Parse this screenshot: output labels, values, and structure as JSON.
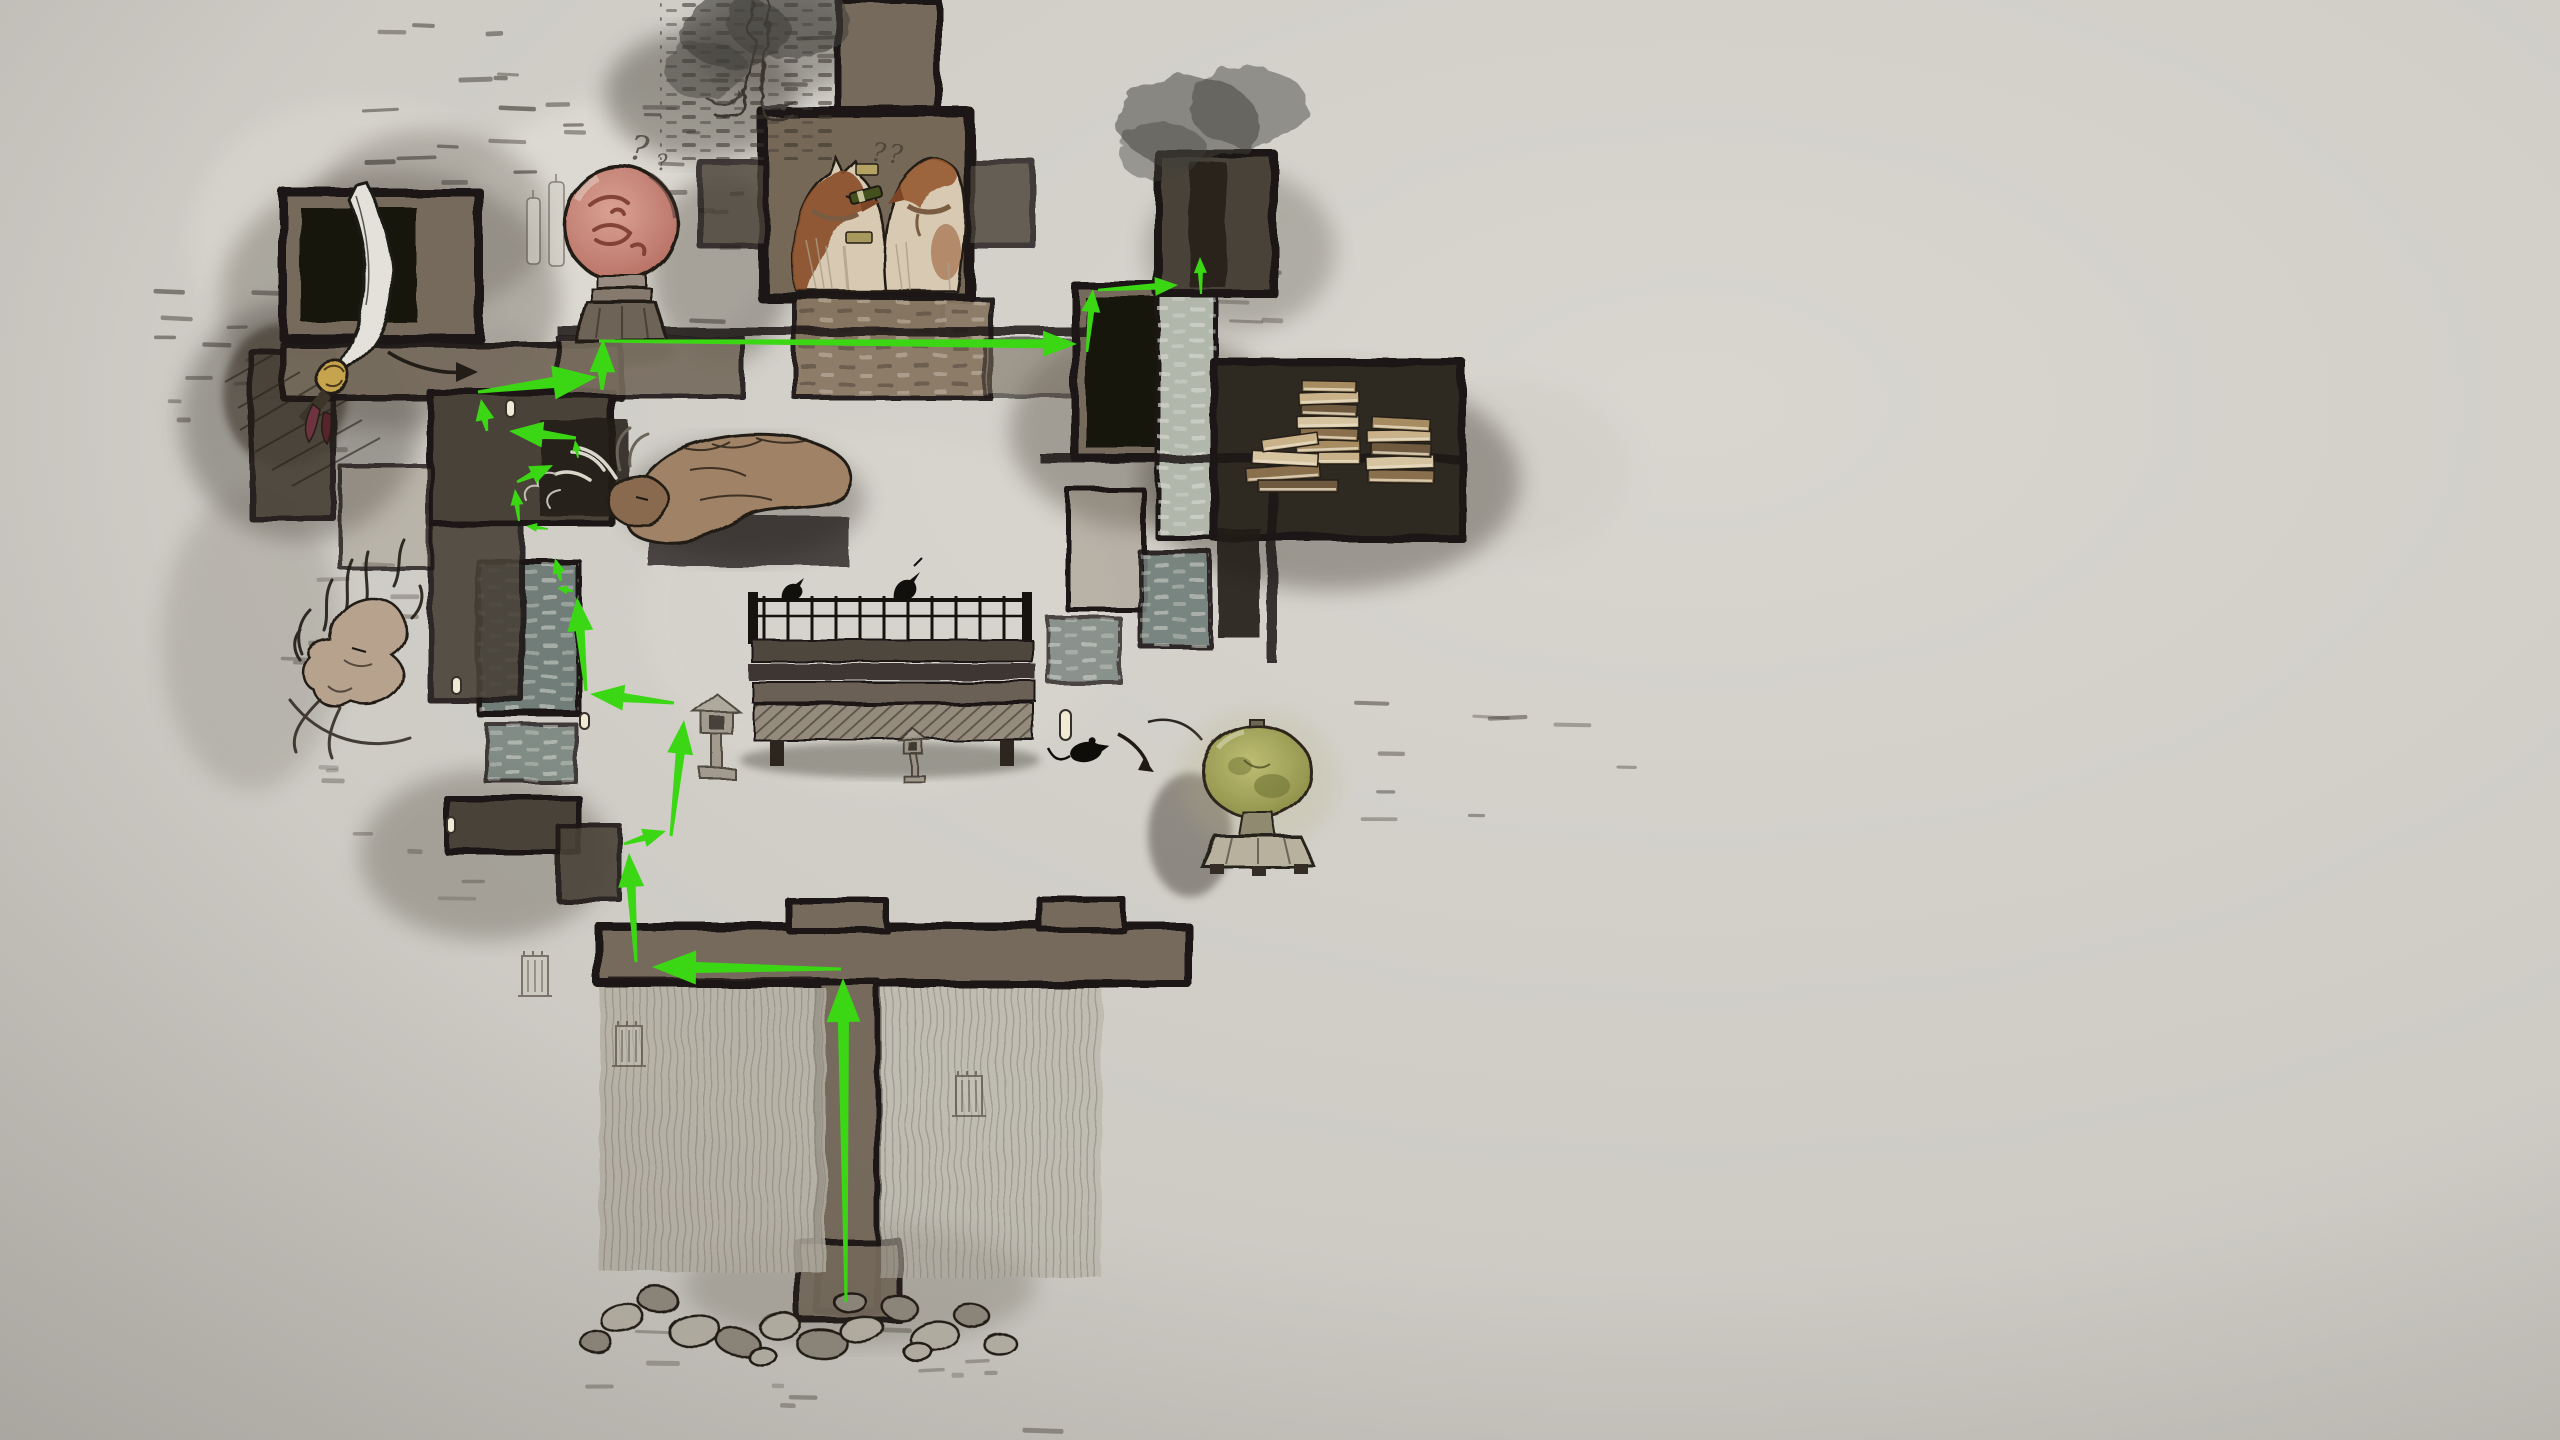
{
  "scene": {
    "width": 2560,
    "height": 1440,
    "description": "hand-drawn ink-wash dungeon map with green route overlay"
  },
  "palette": {
    "bg_light": "#d8d6cf",
    "bg_mid": "#c9c7c0",
    "bg_dark": "#b5b3ac",
    "ink": "#1c1813",
    "room_warm": "#746a5c",
    "room_dark": "#4a4238",
    "room_deep": "#2e2922",
    "room_black": "#17130e",
    "brick_light": "#b2b7ac",
    "brick_blue": "#6f7d78",
    "brick_warm": "#8a7864",
    "wall_brown": "#766856",
    "route_green": "#3cd714",
    "face_pink": "#c9837a",
    "face_line": "#7d3a2f",
    "dog_brown": "#8a4f2b",
    "dog_cream": "#d8cab2",
    "lantern_green": "#9a9b4a",
    "book_tan": "#c9b28a",
    "paper": "#e9e7e0"
  },
  "annotations": {
    "face_mark_primary": "?",
    "face_mark_secondary": "?",
    "kennel_marks": "??"
  },
  "route": {
    "color": "#3cd714",
    "presets": {
      "xl": {
        "hl": 44,
        "hw": 34,
        "nw": 11,
        "tw": 3
      },
      "l": {
        "hl": 34,
        "hw": 26,
        "nw": 9,
        "tw": 3
      },
      "m": {
        "hl": 23,
        "hw": 19,
        "nw": 6.5,
        "tw": 2.5
      },
      "s": {
        "hl": 16,
        "hw": 13,
        "nw": 5,
        "tw": 2
      },
      "xs": {
        "hl": 11,
        "hw": 9,
        "nw": 3.5,
        "tw": 1.5
      }
    },
    "arrows": [
      {
        "x1": 846,
        "y1": 1302,
        "x2": 843,
        "y2": 978,
        "s": "xl"
      },
      {
        "x1": 841,
        "y1": 969,
        "x2": 652,
        "y2": 967,
        "s": "xl"
      },
      {
        "x1": 636,
        "y1": 962,
        "x2": 629,
        "y2": 853,
        "s": "l"
      },
      {
        "x1": 624,
        "y1": 844,
        "x2": 666,
        "y2": 831,
        "s": "m"
      },
      {
        "x1": 671,
        "y1": 836,
        "x2": 684,
        "y2": 720,
        "s": "l"
      },
      {
        "x1": 674,
        "y1": 703,
        "x2": 590,
        "y2": 694,
        "s": "l"
      },
      {
        "x1": 586,
        "y1": 691,
        "x2": 577,
        "y2": 597,
        "s": "l"
      },
      {
        "x1": 573,
        "y1": 591,
        "x2": 557,
        "y2": 588,
        "s": "xs"
      },
      {
        "x1": 561,
        "y1": 581,
        "x2": 555,
        "y2": 558,
        "s": "s"
      },
      {
        "x1": 548,
        "y1": 529,
        "x2": 526,
        "y2": 526,
        "s": "xs"
      },
      {
        "x1": 519,
        "y1": 521,
        "x2": 515,
        "y2": 489,
        "s": "s"
      },
      {
        "x1": 517,
        "y1": 482,
        "x2": 553,
        "y2": 465,
        "s": "m"
      },
      {
        "x1": 578,
        "y1": 458,
        "x2": 575,
        "y2": 440,
        "s": "xs"
      },
      {
        "x1": 576,
        "y1": 438,
        "x2": 509,
        "y2": 431,
        "s": "l"
      },
      {
        "x1": 487,
        "y1": 431,
        "x2": 481,
        "y2": 399,
        "s": "m"
      },
      {
        "x1": 478,
        "y1": 392,
        "x2": 597,
        "y2": 377,
        "s": "xl"
      },
      {
        "x1": 602,
        "y1": 390,
        "x2": 603,
        "y2": 339,
        "s": "l"
      },
      {
        "x1": 599,
        "y1": 341,
        "x2": 1077,
        "y2": 344,
        "s": "l"
      },
      {
        "x1": 1087,
        "y1": 352,
        "x2": 1093,
        "y2": 289,
        "s": "m"
      },
      {
        "x1": 1098,
        "y1": 290,
        "x2": 1178,
        "y2": 285,
        "s": "m"
      },
      {
        "x1": 1201,
        "y1": 294,
        "x2": 1200,
        "y2": 257,
        "s": "s"
      }
    ]
  },
  "map": {
    "washes": [
      {
        "cx": 620,
        "cy": 230,
        "rx": 160,
        "ry": 130,
        "f": "#e6e3db",
        "op": 0.55,
        "b": 2
      },
      {
        "cx": 360,
        "cy": 240,
        "rx": 170,
        "ry": 140,
        "f": "#dcd9d1",
        "op": 0.5,
        "b": 2
      },
      {
        "cx": 880,
        "cy": 610,
        "rx": 240,
        "ry": 180,
        "f": "#d8d6ce",
        "op": 0.6,
        "b": 2
      },
      {
        "cx": 1500,
        "cy": 470,
        "rx": 130,
        "ry": 90,
        "f": "#cfccc5",
        "op": 0.5,
        "b": 2
      },
      {
        "cx": 390,
        "cy": 300,
        "rx": 170,
        "ry": 130,
        "f": "#4b443b",
        "op": 0.3,
        "b": 2
      },
      {
        "cx": 300,
        "cy": 420,
        "rx": 120,
        "ry": 120,
        "f": "#3e3830",
        "op": 0.35,
        "b": 2
      },
      {
        "cx": 430,
        "cy": 220,
        "rx": 120,
        "ry": 90,
        "f": "#514a40",
        "op": 0.28,
        "b": 2
      },
      {
        "cx": 720,
        "cy": 270,
        "rx": 70,
        "ry": 95,
        "f": "#443d34",
        "op": 0.35,
        "b": 2
      },
      {
        "cx": 1330,
        "cy": 480,
        "rx": 190,
        "ry": 110,
        "f": "#453e35",
        "op": 0.4,
        "b": 2
      },
      {
        "cx": 1150,
        "cy": 430,
        "rx": 140,
        "ry": 100,
        "f": "#3c352c",
        "op": 0.33,
        "b": 2
      },
      {
        "cx": 700,
        "cy": 95,
        "rx": 95,
        "ry": 65,
        "f": "#4f4b43",
        "op": 0.45,
        "b": 2
      },
      {
        "cx": 778,
        "cy": 42,
        "rx": 85,
        "ry": 52,
        "f": "#545048",
        "op": 0.4,
        "b": 2
      },
      {
        "cx": 860,
        "cy": 1285,
        "rx": 175,
        "ry": 60,
        "f": "#6b6358",
        "op": 0.3,
        "b": 2
      },
      {
        "cx": 485,
        "cy": 855,
        "rx": 125,
        "ry": 85,
        "f": "#463f36",
        "op": 0.3,
        "b": 2
      },
      {
        "cx": 252,
        "cy": 640,
        "rx": 90,
        "ry": 150,
        "f": "#6e675d",
        "op": 0.22,
        "b": 2
      },
      {
        "cx": 1240,
        "cy": 250,
        "rx": 95,
        "ry": 80,
        "f": "#59524a",
        "op": 0.3,
        "b": 2
      },
      {
        "cx": 285,
        "cy": 395,
        "rx": 62,
        "ry": 72,
        "f": "#2b2119",
        "op": 0.5,
        "b": 1
      },
      {
        "cx": 890,
        "cy": 760,
        "rx": 150,
        "ry": 18,
        "f": "#2b261f",
        "op": 0.35,
        "b": 1
      },
      {
        "cx": 1190,
        "cy": 835,
        "rx": 42,
        "ry": 62,
        "f": "#3c362d",
        "op": 0.45,
        "b": 1
      },
      {
        "cx": 622,
        "cy": 352,
        "rx": 55,
        "ry": 14,
        "f": "#35302a",
        "op": 0.45,
        "b": 1
      },
      {
        "cx": 745,
        "cy": 500,
        "rx": 120,
        "ry": 60,
        "f": "#3a332b",
        "op": 0.3,
        "b": 2
      }
    ],
    "foliage": [
      {
        "cx": 735,
        "cy": 32,
        "rx": 55,
        "ry": 36,
        "op": 0.6
      },
      {
        "cx": 788,
        "cy": 20,
        "rx": 62,
        "ry": 40,
        "op": 0.55
      },
      {
        "cx": 706,
        "cy": 70,
        "rx": 42,
        "ry": 28,
        "op": 0.45
      },
      {
        "cx": 1188,
        "cy": 122,
        "rx": 70,
        "ry": 45,
        "op": 0.5
      },
      {
        "cx": 1248,
        "cy": 106,
        "rx": 60,
        "ry": 40,
        "op": 0.45
      },
      {
        "cx": 1162,
        "cy": 152,
        "rx": 45,
        "ry": 30,
        "op": 0.4
      }
    ],
    "rooms": [
      {
        "n": "room-topleft",
        "x": 283,
        "y": 192,
        "w": 196,
        "h": 146,
        "t": "warm",
        "sw": 9
      },
      {
        "n": "room-topleft-inner",
        "x": 301,
        "y": 208,
        "w": 116,
        "h": 114,
        "t": "black",
        "sw": 0
      },
      {
        "n": "room-left-wing",
        "x": 251,
        "y": 352,
        "w": 82,
        "h": 166,
        "t": "dark",
        "sw": 6,
        "op": 0.9
      },
      {
        "n": "corridor-left",
        "x": 283,
        "y": 344,
        "w": 338,
        "h": 54,
        "t": "warm",
        "sw": 6,
        "op": 0.95
      },
      {
        "n": "room-mid-cluster",
        "x": 430,
        "y": 392,
        "w": 182,
        "h": 132,
        "t": "dark",
        "sw": 7
      },
      {
        "n": "room-mid-black",
        "x": 540,
        "y": 420,
        "w": 88,
        "h": 96,
        "t": "slab",
        "sw": 0,
        "op": 0.85
      },
      {
        "n": "room-bluebrick",
        "x": 479,
        "y": 562,
        "w": 100,
        "h": 152,
        "t": "brickB",
        "sw": 6
      },
      {
        "n": "room-left-mid",
        "x": 430,
        "y": 524,
        "w": 92,
        "h": 176,
        "t": "dark",
        "sw": 6,
        "op": 0.9
      },
      {
        "n": "brick-floor",
        "x": 486,
        "y": 724,
        "w": 90,
        "h": 58,
        "t": "brickB",
        "sw": 4,
        "op": 0.8
      },
      {
        "n": "room-low-1",
        "x": 447,
        "y": 798,
        "w": 132,
        "h": 54,
        "t": "dark",
        "sw": 6
      },
      {
        "n": "room-low-2",
        "x": 558,
        "y": 826,
        "w": 62,
        "h": 74,
        "t": "dark",
        "sw": 5,
        "op": 0.9
      },
      {
        "n": "room-railing",
        "x": 340,
        "y": 466,
        "w": 92,
        "h": 102,
        "t": "outline",
        "sw": 4,
        "op": 0.8
      },
      {
        "n": "chimney",
        "x": 838,
        "y": 0,
        "w": 100,
        "h": 118,
        "t": "warm",
        "sw": 7
      },
      {
        "n": "kennel-room",
        "x": 763,
        "y": 112,
        "w": 206,
        "h": 186,
        "t": "kennel",
        "sw": 11
      },
      {
        "n": "kennel-arm-left",
        "x": 700,
        "y": 162,
        "w": 66,
        "h": 84,
        "t": "dark",
        "sw": 6,
        "op": 0.8
      },
      {
        "n": "kennel-arm-right",
        "x": 967,
        "y": 162,
        "w": 66,
        "h": 84,
        "t": "dark",
        "sw": 6,
        "op": 0.8
      },
      {
        "n": "kennel-base",
        "x": 800,
        "y": 294,
        "w": 142,
        "h": 50,
        "t": "dark",
        "sw": 6
      },
      {
        "n": "brick-below-kennel",
        "x": 795,
        "y": 298,
        "w": 196,
        "h": 100,
        "t": "brickW",
        "sw": 5,
        "op": 0.95
      },
      {
        "n": "corridor-main",
        "x": 558,
        "y": 338,
        "w": 184,
        "h": 58,
        "t": "warm",
        "sw": 5,
        "op": 0.9
      },
      {
        "n": "corridor-main-fade",
        "x": 985,
        "y": 340,
        "w": 100,
        "h": 56,
        "t": "warm",
        "sw": 4,
        "op": 0.55
      },
      {
        "n": "tr-room",
        "x": 1075,
        "y": 286,
        "w": 96,
        "h": 172,
        "t": "warm",
        "sw": 8
      },
      {
        "n": "tr-room-inner",
        "x": 1086,
        "y": 298,
        "w": 70,
        "h": 150,
        "t": "black",
        "sw": 0
      },
      {
        "n": "tr-shaft",
        "x": 1158,
        "y": 286,
        "w": 58,
        "h": 252,
        "t": "brickL",
        "sw": 5
      },
      {
        "n": "tr-tower",
        "x": 1158,
        "y": 154,
        "w": 116,
        "h": 140,
        "t": "dark",
        "sw": 8
      },
      {
        "n": "tr-tower-inner",
        "x": 1190,
        "y": 162,
        "w": 36,
        "h": 126,
        "t": "slab",
        "sw": 0,
        "op": 0.8
      },
      {
        "n": "books-room",
        "x": 1214,
        "y": 362,
        "w": 248,
        "h": 176,
        "t": "deep",
        "sw": 8
      },
      {
        "n": "tr-mid-room-1",
        "x": 1068,
        "y": 490,
        "w": 76,
        "h": 120,
        "t": "outline",
        "sw": 5
      },
      {
        "n": "tr-mid-room-2",
        "x": 1140,
        "y": 552,
        "w": 70,
        "h": 94,
        "t": "brickB",
        "sw": 5,
        "op": 0.9
      },
      {
        "n": "tr-mid-room-3",
        "x": 1048,
        "y": 618,
        "w": 72,
        "h": 64,
        "t": "brickB",
        "sw": 4,
        "op": 0.75
      },
      {
        "n": "tr-slab",
        "x": 1218,
        "y": 528,
        "w": 42,
        "h": 110,
        "t": "slab",
        "sw": 0,
        "op": 0.9
      },
      {
        "n": "bottom-bar",
        "x": 598,
        "y": 926,
        "w": 590,
        "h": 58,
        "t": "warm",
        "sw": 8
      },
      {
        "n": "bar-notch-1",
        "x": 788,
        "y": 900,
        "w": 98,
        "h": 30,
        "t": "warm",
        "sw": 6
      },
      {
        "n": "bar-notch-2",
        "x": 1040,
        "y": 900,
        "w": 84,
        "h": 30,
        "t": "warm",
        "sw": 6
      },
      {
        "n": "bottom-shaft",
        "x": 818,
        "y": 982,
        "w": 60,
        "h": 330,
        "t": "warm",
        "sw": 7
      },
      {
        "n": "bottom-flare",
        "x": 798,
        "y": 1242,
        "w": 102,
        "h": 78,
        "t": "warm",
        "sw": 6,
        "op": 0.95
      },
      {
        "n": "hatch-left",
        "x": 600,
        "y": 988,
        "w": 226,
        "h": 284,
        "t": "hatch",
        "sw": 0,
        "op": 0.85
      },
      {
        "n": "hatch-right",
        "x": 880,
        "y": 988,
        "w": 222,
        "h": 290,
        "t": "hatch",
        "sw": 0,
        "op": 0.55
      }
    ],
    "walls": [
      {
        "x": 558,
        "y": 327,
        "w": 532,
        "h": 9
      },
      {
        "x": 1040,
        "y": 454,
        "w": 420,
        "h": 9
      },
      {
        "x": 1267,
        "y": 463,
        "w": 10,
        "h": 200
      },
      {
        "x": 610,
        "y": 978,
        "w": 220,
        "h": 7
      }
    ],
    "doors": [
      {
        "x": 506,
        "y": 400,
        "w": 9,
        "h": 17
      },
      {
        "x": 452,
        "y": 677,
        "w": 9,
        "h": 17
      },
      {
        "x": 580,
        "y": 713,
        "w": 9,
        "h": 16
      },
      {
        "x": 447,
        "y": 817,
        "w": 8,
        "h": 16
      },
      {
        "x": 1060,
        "y": 710,
        "w": 11,
        "h": 30
      }
    ],
    "towers": [
      {
        "x": 522,
        "y": 956
      },
      {
        "x": 616,
        "y": 1026
      },
      {
        "x": 956,
        "y": 1076
      }
    ],
    "rocks": [
      {
        "cx": 622,
        "cy": 1318,
        "rx": 22,
        "ry": 14,
        "r": -8,
        "d": 0
      },
      {
        "cx": 658,
        "cy": 1300,
        "rx": 20,
        "ry": 13,
        "r": 6,
        "d": 1
      },
      {
        "cx": 694,
        "cy": 1330,
        "rx": 26,
        "ry": 16,
        "r": -4,
        "d": 0
      },
      {
        "cx": 738,
        "cy": 1342,
        "rx": 22,
        "ry": 13,
        "r": 10,
        "d": 1
      },
      {
        "cx": 780,
        "cy": 1326,
        "rx": 20,
        "ry": 12,
        "r": -12,
        "d": 0
      },
      {
        "cx": 822,
        "cy": 1344,
        "rx": 26,
        "ry": 15,
        "r": 4,
        "d": 1
      },
      {
        "cx": 862,
        "cy": 1330,
        "rx": 22,
        "ry": 13,
        "r": -6,
        "d": 0
      },
      {
        "cx": 900,
        "cy": 1308,
        "rx": 18,
        "ry": 12,
        "r": 8,
        "d": 1
      },
      {
        "cx": 934,
        "cy": 1336,
        "rx": 24,
        "ry": 14,
        "r": -10,
        "d": 0
      },
      {
        "cx": 972,
        "cy": 1316,
        "rx": 18,
        "ry": 11,
        "r": 6,
        "d": 1
      },
      {
        "cx": 1000,
        "cy": 1344,
        "rx": 16,
        "ry": 10,
        "r": -4,
        "d": 0
      },
      {
        "cx": 596,
        "cy": 1342,
        "rx": 16,
        "ry": 11,
        "r": 6,
        "d": 1
      },
      {
        "cx": 850,
        "cy": 1302,
        "rx": 16,
        "ry": 10,
        "r": 0,
        "d": 1
      },
      {
        "cx": 918,
        "cy": 1352,
        "rx": 14,
        "ry": 9,
        "r": 0,
        "d": 0
      },
      {
        "cx": 762,
        "cy": 1356,
        "rx": 14,
        "ry": 9,
        "r": 0,
        "d": 0
      }
    ],
    "books": [
      {
        "x": 1298,
        "y": 452,
        "w": 62,
        "h": 12,
        "r": 0
      },
      {
        "x": 1296,
        "y": 440,
        "w": 64,
        "h": 12,
        "r": -2
      },
      {
        "x": 1300,
        "y": 428,
        "w": 58,
        "h": 12,
        "r": 2
      },
      {
        "x": 1297,
        "y": 416,
        "w": 62,
        "h": 12,
        "r": -1
      },
      {
        "x": 1301,
        "y": 404,
        "w": 56,
        "h": 12,
        "r": 2
      },
      {
        "x": 1299,
        "y": 392,
        "w": 60,
        "h": 12,
        "r": -2
      },
      {
        "x": 1302,
        "y": 381,
        "w": 54,
        "h": 11,
        "r": 1
      },
      {
        "x": 1368,
        "y": 470,
        "w": 66,
        "h": 13,
        "r": 1
      },
      {
        "x": 1366,
        "y": 456,
        "w": 68,
        "h": 13,
        "r": -2
      },
      {
        "x": 1371,
        "y": 443,
        "w": 60,
        "h": 13,
        "r": 2
      },
      {
        "x": 1367,
        "y": 430,
        "w": 64,
        "h": 12,
        "r": -1
      },
      {
        "x": 1372,
        "y": 418,
        "w": 58,
        "h": 12,
        "r": 3
      },
      {
        "x": 1246,
        "y": 466,
        "w": 74,
        "h": 14,
        "r": -4
      },
      {
        "x": 1252,
        "y": 452,
        "w": 66,
        "h": 13,
        "r": 3
      },
      {
        "x": 1258,
        "y": 480,
        "w": 80,
        "h": 12,
        "r": 0
      },
      {
        "x": 1262,
        "y": 436,
        "w": 56,
        "h": 12,
        "r": -8
      }
    ],
    "book_colors": [
      "#c9b28a",
      "#a78c62",
      "#8a6f4d",
      "#d6c4a0",
      "#6f5a40"
    ],
    "dash_regions": [
      {
        "x": 360,
        "y": 20,
        "w": 470,
        "h": 190,
        "n": 26,
        "c": "#2b2620",
        "op": 0.55
      },
      {
        "x": 560,
        "y": 120,
        "w": 170,
        "h": 200,
        "n": 10,
        "c": "#332d26",
        "op": 0.5
      },
      {
        "x": 150,
        "y": 276,
        "w": 180,
        "h": 150,
        "n": 12,
        "c": "#2b2620",
        "op": 0.5
      },
      {
        "x": 250,
        "y": 430,
        "w": 150,
        "h": 240,
        "n": 10,
        "c": "#332d26",
        "op": 0.4
      },
      {
        "x": 300,
        "y": 760,
        "w": 220,
        "h": 150,
        "n": 8,
        "c": "#3a342c",
        "op": 0.35
      },
      {
        "x": 1310,
        "y": 690,
        "w": 320,
        "h": 130,
        "n": 9,
        "c": "#39332b",
        "op": 0.5
      },
      {
        "x": 560,
        "y": 1320,
        "w": 470,
        "h": 110,
        "n": 12,
        "c": "#4a443a",
        "op": 0.45
      },
      {
        "x": 1180,
        "y": 240,
        "w": 120,
        "h": 100,
        "n": 6,
        "c": "#39332b",
        "op": 0.4
      }
    ]
  }
}
